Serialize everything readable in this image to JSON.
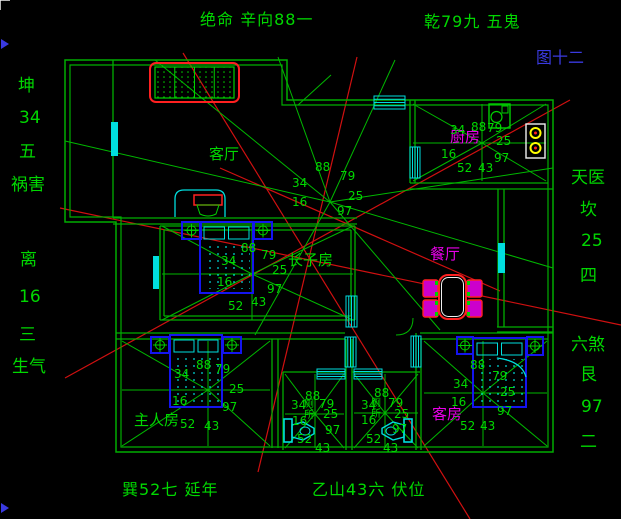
{
  "figure_label": {
    "text": "图十二",
    "color": "#3a3ae0"
  },
  "title_annotations": {
    "top_left": "绝命 辛向88一",
    "top_right": "乾79九 五鬼",
    "bottom_left": "巽52七 延年",
    "bottom_right": "乙山43六 伏位"
  },
  "palette": {
    "background": "#000000",
    "wall_green": "#00ae00",
    "ray_green": "#00b800",
    "text_green": "#00d800",
    "red_line": "#d01010",
    "bright_red": "#ff2020",
    "cyan": "#00dede",
    "furniture_blue": "#1414f0",
    "magenta": "#e800e8",
    "yellow": "#ffff00",
    "figure_blue": "#3a3ae0",
    "white": "#f0f0f0"
  },
  "side_labels": {
    "left": [
      {
        "text": "坤",
        "x": 18,
        "y": 76
      },
      {
        "text": "34",
        "x": 19,
        "y": 108
      },
      {
        "text": "五",
        "x": 19,
        "y": 142
      },
      {
        "text": "祸害",
        "x": 11,
        "y": 175
      },
      {
        "text": "离",
        "x": 20,
        "y": 250
      },
      {
        "text": "16",
        "x": 19,
        "y": 287
      },
      {
        "text": "三",
        "x": 19,
        "y": 325
      },
      {
        "text": "生气",
        "x": 12,
        "y": 357
      }
    ],
    "right": [
      {
        "text": "天医",
        "x": 571,
        "y": 168
      },
      {
        "text": "坎",
        "x": 580,
        "y": 200
      },
      {
        "text": "25",
        "x": 581,
        "y": 231
      },
      {
        "text": "四",
        "x": 580,
        "y": 266
      },
      {
        "text": "六煞",
        "x": 571,
        "y": 335
      },
      {
        "text": "艮",
        "x": 580,
        "y": 365
      },
      {
        "text": "97",
        "x": 581,
        "y": 397
      },
      {
        "text": "二",
        "x": 580,
        "y": 432
      }
    ]
  },
  "room_labels": [
    {
      "name": "living-room",
      "text": "客厅",
      "x": 209,
      "y": 145,
      "color": "green",
      "vertical": false
    },
    {
      "name": "kitchen",
      "text": "厨房",
      "x": 450,
      "y": 128,
      "color": "magenta",
      "vertical": false
    },
    {
      "name": "dining-room",
      "text": "餐厅",
      "x": 430,
      "y": 245,
      "color": "magenta",
      "vertical": false
    },
    {
      "name": "eldest-son-room",
      "text": "长子房",
      "x": 288,
      "y": 251,
      "color": "green",
      "vertical": false
    },
    {
      "name": "master-room",
      "text": "主人房",
      "x": 134,
      "y": 411,
      "color": "green",
      "vertical": false
    },
    {
      "name": "guest-room",
      "text": "客房",
      "x": 432,
      "y": 405,
      "color": "magenta",
      "vertical": false
    },
    {
      "name": "toilet-left",
      "text": "厕所",
      "x": 304,
      "y": 397,
      "color": "green",
      "vertical": true
    },
    {
      "name": "toilet-right",
      "text": "厕所",
      "x": 371,
      "y": 396,
      "color": "green",
      "vertical": true
    }
  ],
  "stars": [
    {
      "name": "house",
      "cx": 330,
      "cy": 202,
      "ray_ends": [
        [
          65,
          141
        ],
        [
          155,
          60
        ],
        [
          278,
          57
        ],
        [
          395,
          60
        ],
        [
          553,
          168
        ],
        [
          553,
          268
        ],
        [
          440,
          330
        ],
        [
          255,
          335
        ]
      ],
      "numbers": [
        [
          "88",
          315,
          160
        ],
        [
          "79",
          340,
          169
        ],
        [
          "34",
          292,
          176
        ],
        [
          "25",
          348,
          189
        ],
        [
          "16",
          292,
          195
        ],
        [
          "97",
          337,
          204
        ]
      ]
    },
    {
      "name": "eldest-son-room",
      "cx": 252,
      "cy": 274,
      "room": [
        162,
        226,
        353,
        320
      ],
      "numbers": [
        [
          "88",
          241,
          241
        ],
        [
          "79",
          261,
          248
        ],
        [
          "34",
          221,
          254
        ],
        [
          "25",
          272,
          263
        ],
        [
          "16",
          217,
          275
        ],
        [
          "97",
          267,
          282
        ],
        [
          "43",
          251,
          295
        ],
        [
          "52",
          228,
          299
        ]
      ]
    },
    {
      "name": "kitchen",
      "cx": 482,
      "cy": 143,
      "room": [
        413,
        104,
        546,
        181
      ],
      "numbers": [
        [
          "88",
          471,
          120
        ],
        [
          "79",
          487,
          121
        ],
        [
          "34",
          450,
          123
        ],
        [
          "25",
          496,
          134
        ],
        [
          "16",
          441,
          147
        ],
        [
          "97",
          494,
          151
        ],
        [
          "43",
          478,
          161
        ],
        [
          "52",
          457,
          161
        ]
      ]
    },
    {
      "name": "master-room",
      "cx": 208,
      "cy": 390,
      "room": [
        122,
        341,
        270,
        446
      ],
      "numbers": [
        [
          "88",
          196,
          358
        ],
        [
          "79",
          215,
          362
        ],
        [
          "34",
          174,
          367
        ],
        [
          "25",
          229,
          382
        ],
        [
          "16",
          172,
          394
        ],
        [
          "97",
          222,
          400
        ],
        [
          "52",
          180,
          417
        ],
        [
          "43",
          204,
          419
        ]
      ]
    },
    {
      "name": "bath-left",
      "cx": 315,
      "cy": 414,
      "room": [
        285,
        374,
        344,
        448
      ],
      "numbers": [
        [
          "88",
          305,
          389
        ],
        [
          "79",
          319,
          397
        ],
        [
          "34",
          291,
          398
        ],
        [
          "25",
          323,
          407
        ],
        [
          "16",
          292,
          414
        ],
        [
          "97",
          325,
          423
        ],
        [
          "52",
          297,
          432
        ],
        [
          "43",
          315,
          441
        ]
      ]
    },
    {
      "name": "bath-right",
      "cx": 385,
      "cy": 413,
      "room": [
        354,
        374,
        418,
        448
      ],
      "numbers": [
        [
          "88",
          374,
          386
        ],
        [
          "79",
          388,
          396
        ],
        [
          "34",
          361,
          398
        ],
        [
          "25",
          394,
          407
        ],
        [
          "16",
          361,
          413
        ],
        [
          "97",
          392,
          422
        ],
        [
          "52",
          366,
          432
        ],
        [
          "43",
          383,
          441
        ]
      ]
    },
    {
      "name": "guest-room",
      "cx": 483,
      "cy": 393,
      "room": [
        424,
        341,
        547,
        446
      ],
      "numbers": [
        [
          "88",
          470,
          358
        ],
        [
          "79",
          492,
          369
        ],
        [
          "34",
          453,
          377
        ],
        [
          "25",
          500,
          385
        ],
        [
          "16",
          451,
          395
        ],
        [
          "97",
          497,
          404
        ],
        [
          "52",
          460,
          419
        ],
        [
          "43",
          480,
          419
        ]
      ]
    }
  ],
  "plan": {
    "outer_wall": "M65,60 H287 V100 H553 V452 H116 V222 H65 Z",
    "inner_wall": "M70,65 H282 V105 H548 V447 H121 V217 H70 Z",
    "wall_segments": [
      [
        113,
        60,
        113,
        218
      ],
      [
        113,
        218,
        357,
        218
      ],
      [
        113,
        224,
        357,
        224
      ],
      [
        160,
        226,
        355,
        226
      ],
      [
        355,
        226,
        355,
        320
      ],
      [
        160,
        320,
        355,
        320
      ],
      [
        160,
        226,
        160,
        320
      ],
      [
        164,
        230,
        351,
        230
      ],
      [
        351,
        230,
        351,
        316
      ],
      [
        164,
        316,
        351,
        316
      ],
      [
        164,
        230,
        164,
        316
      ],
      [
        410,
        100,
        410,
        183
      ],
      [
        415,
        100,
        415,
        183
      ],
      [
        410,
        183,
        548,
        183
      ],
      [
        410,
        189,
        553,
        189
      ],
      [
        498,
        189,
        498,
        327
      ],
      [
        504,
        189,
        504,
        327
      ],
      [
        497,
        327,
        553,
        327
      ],
      [
        497,
        332,
        553,
        332
      ],
      [
        116,
        333,
        345,
        333
      ],
      [
        116,
        339,
        345,
        339
      ],
      [
        420,
        333,
        553,
        333
      ],
      [
        420,
        339,
        548,
        339
      ],
      [
        346,
        339,
        346,
        372
      ],
      [
        352,
        339,
        352,
        372
      ],
      [
        416,
        333,
        416,
        372
      ],
      [
        421,
        339,
        421,
        372
      ],
      [
        272,
        339,
        272,
        448
      ],
      [
        278,
        339,
        278,
        448
      ],
      [
        283,
        372,
        283,
        450
      ],
      [
        283,
        372,
        345,
        372
      ],
      [
        346,
        372,
        346,
        450
      ],
      [
        352,
        372,
        352,
        450
      ],
      [
        352,
        372,
        420,
        372
      ],
      [
        416,
        372,
        416,
        450
      ],
      [
        421,
        372,
        421,
        450
      ]
    ],
    "windows": [
      {
        "x": 111,
        "y": 122,
        "w": 7,
        "h": 34,
        "style": "solid"
      },
      {
        "x": 153,
        "y": 256,
        "w": 6,
        "h": 33,
        "style": "solid"
      },
      {
        "x": 346,
        "y": 296,
        "w": 11,
        "h": 31,
        "style": "hatch"
      },
      {
        "x": 345,
        "y": 337,
        "w": 11,
        "h": 30,
        "style": "hatch"
      },
      {
        "x": 411,
        "y": 336,
        "w": 10,
        "h": 31,
        "style": "hatch"
      },
      {
        "x": 410,
        "y": 147,
        "w": 10,
        "h": 31,
        "style": "hatch"
      },
      {
        "x": 374,
        "y": 96,
        "w": 31,
        "h": 13,
        "style": "hatch"
      },
      {
        "x": 498,
        "y": 243,
        "w": 7,
        "h": 30,
        "style": "solid"
      },
      {
        "x": 317,
        "y": 369,
        "w": 28,
        "h": 10,
        "style": "hatch"
      },
      {
        "x": 354,
        "y": 369,
        "w": 28,
        "h": 10,
        "style": "hatch"
      }
    ],
    "red_lines": [
      [
        183,
        53,
        470,
        519
      ],
      [
        357,
        57,
        258,
        472
      ],
      [
        60,
        208,
        621,
        325
      ],
      [
        65,
        378,
        570,
        100
      ],
      [
        220,
        168,
        500,
        291
      ]
    ],
    "green_extras": [
      [
        298,
        105,
        331,
        75
      ]
    ],
    "green_arcs": [
      "M413,318 Q413,335 396,335"
    ],
    "fixtures": [
      {
        "type": "sofa",
        "name": "sofa",
        "x": 150,
        "y": 63,
        "w": 89,
        "h": 39
      },
      {
        "type": "tv",
        "name": "tv-cabinet",
        "x": 175,
        "y": 190,
        "w": 50,
        "h": 27
      },
      {
        "type": "bed",
        "name": "bed-eldest-son",
        "x": 200,
        "y": 222,
        "w": 53,
        "h": 71,
        "ns": [
          [
            182,
            222,
            19,
            17
          ],
          [
            254,
            222,
            18,
            17
          ]
        ]
      },
      {
        "type": "bed",
        "name": "bed-master",
        "x": 170,
        "y": 335,
        "w": 52,
        "h": 72,
        "ns": [
          [
            151,
            337,
            18,
            16
          ],
          [
            223,
            337,
            18,
            16
          ]
        ]
      },
      {
        "type": "bed",
        "name": "bed-guest",
        "x": 473,
        "y": 338,
        "w": 53,
        "h": 69,
        "arc": true,
        "ns": [
          [
            457,
            337,
            16,
            17
          ],
          [
            527,
            337,
            16,
            18
          ]
        ]
      },
      {
        "type": "sink",
        "name": "kitchen-sink",
        "x": 489,
        "y": 104,
        "w": 21,
        "h": 24
      },
      {
        "type": "stove",
        "name": "kitchen-stove",
        "x": 526,
        "y": 124,
        "w": 19,
        "h": 34
      },
      {
        "type": "dining",
        "name": "dining-set",
        "table": [
          439,
          275,
          27,
          44
        ],
        "chairs": [
          [
            423,
            280,
            15,
            17
          ],
          [
            423,
            300,
            15,
            17
          ],
          [
            467,
            280,
            15,
            17
          ],
          [
            467,
            300,
            15,
            17
          ]
        ]
      },
      {
        "type": "toilet",
        "name": "toilet-left",
        "tank": [
          284,
          419,
          8,
          23
        ],
        "bowl": [
          292,
          422,
          22,
          18
        ],
        "dir": 1
      },
      {
        "type": "toilet",
        "name": "toilet-right",
        "tank": [
          404,
          419,
          8,
          23
        ],
        "bowl": [
          382,
          422,
          22,
          18
        ],
        "dir": -1
      }
    ],
    "edge_marks": {
      "corner": "M0,10 L0,0 L10,0",
      "triangles": [
        [
          1,
          39,
          9,
          44,
          1,
          49
        ],
        [
          1,
          503,
          9,
          508,
          1,
          513
        ]
      ]
    }
  }
}
